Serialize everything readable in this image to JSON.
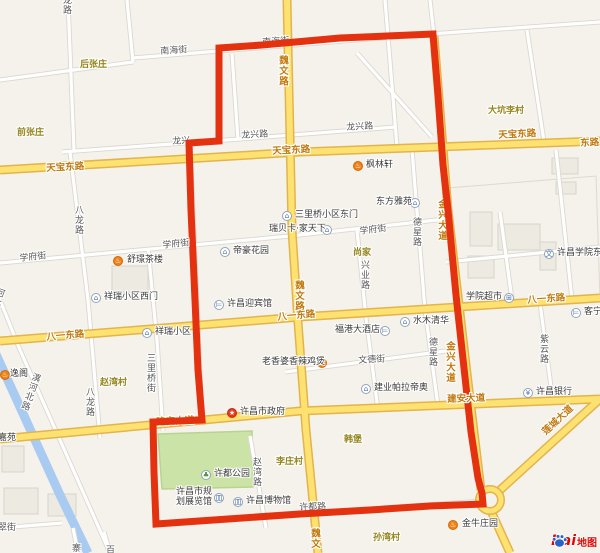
{
  "map": {
    "colors": {
      "background": "#f5f2eb",
      "boundary_red": "#e43210",
      "major_road_fill": "#fde271",
      "major_road_casing": "#e2b44d",
      "minor_road_label": "#595959",
      "major_road_label": "#c1790f",
      "area_label": "#94861d",
      "river_blue": "#a9cbf1",
      "park_green": "#cbe3a6"
    },
    "icons": {
      "residence": {
        "glyph": "⌂"
      },
      "school": {
        "glyph": "文"
      },
      "hotel": {
        "glyph": "⊨"
      },
      "bank": {
        "glyph": "¥"
      },
      "shop": {
        "glyph": "⊞"
      },
      "museum": {
        "glyph": "皿"
      },
      "park": {
        "glyph": "♣"
      },
      "government": {
        "glyph": "★"
      },
      "restaurant": {
        "glyph": "♨"
      }
    },
    "minor_road_labels": [
      {
        "id": "nanhaijie-1",
        "t": "南海街",
        "x": 160,
        "y": 47,
        "r": -4
      },
      {
        "id": "longxinglu-1",
        "t": "龙兴路",
        "x": 241,
        "y": 131,
        "r": -3
      },
      {
        "id": "longxinglu-2",
        "t": "龙兴路",
        "x": 346,
        "y": 123,
        "r": -3
      },
      {
        "id": "xuefujie-1",
        "t": "学府街",
        "x": 19,
        "y": 254,
        "r": -6
      },
      {
        "id": "xuefujie-2",
        "t": "学府街",
        "x": 162,
        "y": 241,
        "r": -6
      },
      {
        "id": "xuefujie-3",
        "t": "学府街",
        "x": 359,
        "y": 227,
        "r": -7
      },
      {
        "id": "balonglu-1",
        "t": "八龙路",
        "x": 73,
        "y": 205,
        "v": true
      },
      {
        "id": "balonglu-2",
        "t": "八龙路",
        "x": 84,
        "y": 387,
        "v": true
      },
      {
        "id": "sanliqiaojie",
        "t": "三里桥街",
        "x": 145,
        "y": 353,
        "v": true
      },
      {
        "id": "dexinglu-1",
        "t": "德星路",
        "x": 411,
        "y": 217,
        "v": true
      },
      {
        "id": "dexinglu-2",
        "t": "德星路",
        "x": 427,
        "y": 337,
        "v": true
      },
      {
        "id": "xingyelu",
        "t": "兴业路",
        "x": 359,
        "y": 260,
        "v": true
      },
      {
        "id": "ziyunlu",
        "t": "紫云路",
        "x": 538,
        "y": 334,
        "v": true
      },
      {
        "id": "zhaowanlu",
        "t": "赵湾路",
        "x": 251,
        "y": 457,
        "v": true
      },
      {
        "id": "yihebeilu",
        "t": "潩河北路",
        "x": 32,
        "y": 371,
        "v": true,
        "r": 20
      },
      {
        "id": "hebeilu-frag",
        "t": "河北路",
        "x": -4,
        "y": 286,
        "v": true,
        "r": 20
      },
      {
        "id": "wendejie",
        "t": "文德街",
        "x": 358,
        "y": 356,
        "r": -3
      },
      {
        "id": "cuijie-frag",
        "t": "翠街",
        "x": -2,
        "y": 523
      },
      {
        "id": "zhai-frag",
        "t": "寨",
        "x": 70,
        "y": 543,
        "v": true
      },
      {
        "id": "bai-frag",
        "t": "百",
        "x": 104,
        "y": 545,
        "v": true
      },
      {
        "id": "longlu-frag",
        "t": "龙路",
        "x": 61,
        "y": -5,
        "v": true
      }
    ],
    "under_red_labels": [
      {
        "id": "nanhaijie-2",
        "t": "南海街",
        "x": 262,
        "y": 38,
        "r": -4
      },
      {
        "id": "longxing-frag",
        "t": "龙兴",
        "x": 172,
        "y": 137,
        "r": -3
      },
      {
        "id": "xudulu",
        "t": "许都路",
        "x": 299,
        "y": 503,
        "r": -2
      },
      {
        "id": "jianan-dadao-2",
        "t": "建安大道",
        "x": 156,
        "y": 418,
        "r": -3,
        "major": true
      },
      {
        "id": "jinxing-dadao-1",
        "t": "金兴大道",
        "x": 437,
        "y": 199,
        "v": true,
        "major": true
      },
      {
        "id": "jinxing-dadao-2",
        "t": "金兴大道",
        "x": 445,
        "y": 341,
        "v": true,
        "major": true
      }
    ],
    "major_road_labels": [
      {
        "id": "tianbao-donglu-1",
        "t": "天宝东路",
        "x": 46,
        "y": 164,
        "r": -3
      },
      {
        "id": "tianbao-donglu-2",
        "t": "天宝东路",
        "x": 272,
        "y": 147,
        "r": -3
      },
      {
        "id": "tianbao-donglu-3",
        "t": "天宝东路",
        "x": 498,
        "y": 131,
        "r": -3
      },
      {
        "id": "donglu-frag",
        "t": "东路",
        "x": 580,
        "y": 139,
        "r": -3
      },
      {
        "id": "weiwenlu-1",
        "t": "魏文路",
        "x": 278,
        "y": 55,
        "v": true
      },
      {
        "id": "weiwenlu-2",
        "t": "魏文路",
        "x": 294,
        "y": 280,
        "v": true
      },
      {
        "id": "weiwen-frag",
        "t": "魏文",
        "x": 310,
        "y": 528,
        "v": true
      },
      {
        "id": "bayi-donglu-1",
        "t": "八一东路",
        "x": 46,
        "y": 333,
        "r": -5
      },
      {
        "id": "bayi-donglu-2",
        "t": "八一东路",
        "x": 277,
        "y": 313,
        "r": -5
      },
      {
        "id": "bayi-donglu-3",
        "t": "八一东路",
        "x": 527,
        "y": 296,
        "r": -4
      },
      {
        "id": "jianan-dadao-1",
        "t": "建安大道",
        "x": 447,
        "y": 395,
        "r": -2
      },
      {
        "id": "liancheng-dadao",
        "t": "莲城大道",
        "x": 541,
        "y": 430,
        "r": -43
      }
    ],
    "area_labels": [
      {
        "id": "houzhangzhuang",
        "t": "后张庄",
        "x": 80,
        "y": 60
      },
      {
        "id": "qianzhangzhuang",
        "t": "前张庄",
        "x": 17,
        "y": 128
      },
      {
        "id": "dakenglicun",
        "t": "大坑李村",
        "x": 488,
        "y": 106
      },
      {
        "id": "shangjia",
        "t": "尚家",
        "x": 353,
        "y": 248
      },
      {
        "id": "zhaowancun",
        "t": "赵湾村",
        "x": 100,
        "y": 378
      },
      {
        "id": "lizhuangcun",
        "t": "李庄村",
        "x": 276,
        "y": 457
      },
      {
        "id": "hanbao",
        "t": "韩堡",
        "x": 344,
        "y": 435
      },
      {
        "id": "sunwancun",
        "t": "孙湾村",
        "x": 373,
        "y": 533
      }
    ],
    "pois": [
      {
        "id": "fenglinxuan",
        "t": "枫林轩",
        "tx": 366,
        "ty": 160,
        "icon": "restaurant",
        "ix": 353,
        "iy": 161
      },
      {
        "id": "shujing-chalou",
        "t": "舒璟茶楼",
        "tx": 127,
        "ty": 255,
        "icon": "restaurant",
        "ix": 113,
        "iy": 256
      },
      {
        "id": "dihao-huayuan",
        "t": "帝豪花园",
        "tx": 233,
        "ty": 246,
        "icon": "residence",
        "ix": 220,
        "iy": 247
      },
      {
        "id": "sanliqiao-xiaoqu-dongmen",
        "t": "三里桥小区东门",
        "tx": 295,
        "ty": 210,
        "icon": "residence",
        "ix": 282,
        "iy": 211
      },
      {
        "id": "ruibeika-jiatianxia",
        "t": "瑞贝卡·家天下",
        "tx": 269,
        "ty": 224,
        "icon": "residence",
        "ix": 322,
        "iy": 225
      },
      {
        "id": "dongfang-yayuan",
        "t": "东方雅苑",
        "tx": 376,
        "ty": 197,
        "icon": "residence",
        "ix": 410,
        "iy": 198
      },
      {
        "id": "xiangrui-xiaoqu-ximen",
        "t": "祥瑞小区西门",
        "tx": 104,
        "ty": 292,
        "icon": "residence",
        "ix": 91,
        "iy": 293
      },
      {
        "id": "xiangrui-xiaoqu",
        "t": "祥瑞小区",
        "tx": 155,
        "ty": 327,
        "icon": "residence",
        "ix": 142,
        "iy": 328
      },
      {
        "id": "xuchang-yingbinguan",
        "t": "许昌迎宾馆",
        "tx": 227,
        "ty": 299,
        "icon": "hotel",
        "ix": 214,
        "iy": 300
      },
      {
        "id": "xueyuan-chaoshi",
        "t": "学院超市",
        "tx": 466,
        "ty": 292,
        "icon": "shop",
        "ix": 504,
        "iy": 293
      },
      {
        "id": "xuchang-xueyuan-dong",
        "t": "许昌学院东校区",
        "tx": 557,
        "ty": 248,
        "icon": "school",
        "ix": 544,
        "iy": 249
      },
      {
        "id": "shuimu-qinghua",
        "t": "水木清华",
        "tx": 413,
        "ty": 316,
        "icon": "residence",
        "ix": 400,
        "iy": 317
      },
      {
        "id": "fugang-dajiudian",
        "t": "福港大酒店",
        "tx": 335,
        "ty": 325,
        "icon": "hotel",
        "ix": 380,
        "iy": 326
      },
      {
        "id": "kening",
        "t": "客宁",
        "tx": 584,
        "ty": 307,
        "icon": "hotel",
        "ix": 571,
        "iy": 308
      },
      {
        "id": "xuchang-yinhang",
        "t": "许昌银行",
        "tx": 536,
        "ty": 387,
        "icon": "bank",
        "ix": 523,
        "iy": 388
      },
      {
        "id": "laoxiangpo-jibao",
        "t": "老香婆香辣鸡煲",
        "tx": 262,
        "ty": 357,
        "icon": "restaurant",
        "ix": 317,
        "iy": 358
      },
      {
        "id": "jianye-paladiao",
        "t": "建业帕拉帝奥",
        "tx": 374,
        "ty": 383,
        "icon": "residence",
        "ix": 361,
        "iy": 384
      },
      {
        "id": "xuchang-shizhengfu",
        "t": "许昌市政府",
        "tx": 240,
        "ty": 407,
        "icon": "government",
        "ix": 227,
        "iy": 408
      },
      {
        "id": "xudu-gongyuan",
        "t": "许都公园",
        "tx": 214,
        "ty": 469,
        "icon": "park",
        "ix": 201,
        "iy": 470
      },
      {
        "id": "guihua-zhanlanguan",
        "lines": [
          "许昌市规",
          "划展览馆"
        ],
        "tx": 176,
        "ty": 487,
        "icon": "museum",
        "ix": 214,
        "iy": 493
      },
      {
        "id": "xuchang-bowuguan",
        "t": "许昌博物馆",
        "tx": 246,
        "ty": 496,
        "icon": "museum",
        "ix": 233,
        "iy": 497
      },
      {
        "id": "jinniu-zhuangyuan",
        "t": "金牛庄园",
        "tx": 462,
        "ty": 519,
        "icon": "restaurant",
        "ix": 448,
        "iy": 520
      },
      {
        "id": "qingyige",
        "t": "逸阁",
        "tx": 10,
        "ty": 369,
        "icon": "restaurant",
        "ix": 0,
        "iy": 370
      },
      {
        "id": "jiayuan",
        "t": "嘉苑",
        "tx": -2,
        "ty": 433
      }
    ],
    "logo": {
      "bai": "Bai",
      "ditu": "地图"
    }
  }
}
